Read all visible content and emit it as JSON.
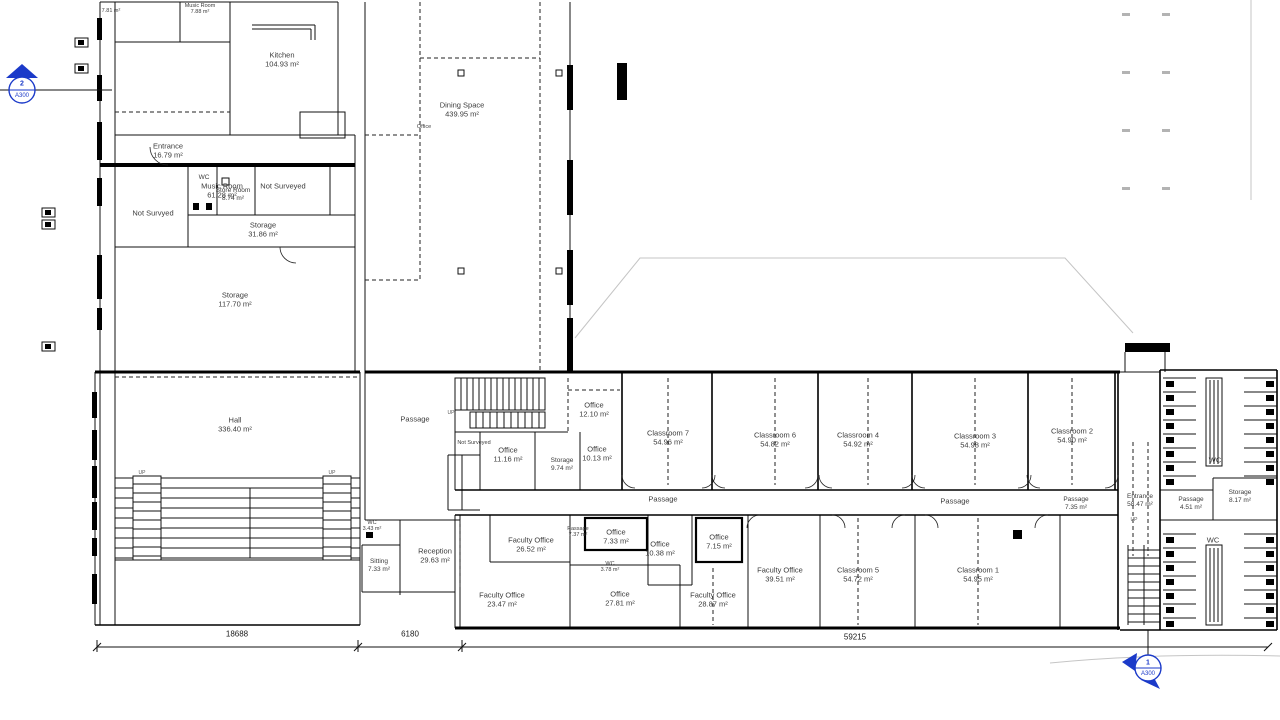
{
  "colors": {
    "wall": "#000000",
    "annotation_blue": "#1b3ac9",
    "site_gray": "#bdbdbd"
  },
  "up_label": "UP",
  "dimensions": {
    "d1": "18688",
    "d2": "6180",
    "d3": "59215"
  },
  "markers": {
    "left": {
      "number": "2",
      "sheet": "A300"
    },
    "bottom": {
      "number": "1",
      "sheet": "A300"
    }
  },
  "rooms": {
    "music_room_upper": {
      "name": "Music Room",
      "area": "7.88 m²"
    },
    "room_781": {
      "name": "",
      "area": "7.81 m²"
    },
    "music_room": {
      "name": "Music Room",
      "area": "61.28 m²"
    },
    "kitchen": {
      "name": "Kitchen",
      "area": "104.93 m²"
    },
    "dining_space": {
      "name": "Dining Space",
      "area": "439.95 m²"
    },
    "entrance_west": {
      "name": "Entrance",
      "area": "16.79 m²"
    },
    "wc_west": {
      "name": "WC",
      "area": ""
    },
    "store_room": {
      "name": "Store Room",
      "area": "8.74 m²"
    },
    "not_surveyed_east": {
      "name": "Not Surveyed",
      "area": ""
    },
    "not_survyed_west": {
      "name": "Not Survyed",
      "area": ""
    },
    "storage_small": {
      "name": "Storage",
      "area": "31.86 m²"
    },
    "storage_large": {
      "name": "Storage",
      "area": "117.70 m²"
    },
    "hall": {
      "name": "Hall",
      "area": "336.40 m²"
    },
    "passage_hall": {
      "name": "Passage",
      "area": ""
    },
    "office_top_small": {
      "name": "Office",
      "area": ""
    },
    "office_1210": {
      "name": "Office",
      "area": "12.10 m²"
    },
    "office_1116": {
      "name": "Office",
      "area": "11.16 m²"
    },
    "storage_974": {
      "name": "Storage",
      "area": "9.74 m²"
    },
    "office_1013": {
      "name": "Office",
      "area": "10.13 m²"
    },
    "not_surveyed_small": {
      "name": "Not Surveyed",
      "area": ""
    },
    "classroom_7": {
      "name": "Classroom 7",
      "area": "54.96 m²"
    },
    "classroom_6": {
      "name": "Classroom 6",
      "area": "54.82 m²"
    },
    "classroom_4": {
      "name": "Classroom 4",
      "area": "54.92 m²"
    },
    "classroom_3": {
      "name": "Classroom 3",
      "area": "54.98 m²"
    },
    "classroom_2": {
      "name": "Classroom 2",
      "area": "54.90 m²"
    },
    "passage_corridor_west": {
      "name": "Passage",
      "area": ""
    },
    "passage_corridor_east": {
      "name": "Passage",
      "area": ""
    },
    "passage_735": {
      "name": "Passage",
      "area": "7.35 m²"
    },
    "entrance_east": {
      "name": "Entrance",
      "area": "58.47 m²"
    },
    "passage_451": {
      "name": "Passage",
      "area": "4.51 m²"
    },
    "storage_817": {
      "name": "Storage",
      "area": "8.17 m²"
    },
    "wc_north": {
      "name": "WC",
      "area": ""
    },
    "wc_south": {
      "name": "WC",
      "area": ""
    },
    "sitting": {
      "name": "Sitting",
      "area": "7.33 m²"
    },
    "reception": {
      "name": "Reception",
      "area": "29.63 m²"
    },
    "faculty_2652": {
      "name": "Faculty Office",
      "area": "26.52 m²"
    },
    "faculty_2347": {
      "name": "Faculty Office",
      "area": "23.47 m²"
    },
    "office_733": {
      "name": "Office",
      "area": "7.33 m²"
    },
    "office_1038": {
      "name": "Office",
      "area": "10.38 m²"
    },
    "office_715": {
      "name": "Office",
      "area": "7.15 m²"
    },
    "office_2781": {
      "name": "Office",
      "area": "27.81 m²"
    },
    "faculty_2887": {
      "name": "Faculty Office",
      "area": "28.87 m²"
    },
    "faculty_3951": {
      "name": "Faculty Office",
      "area": "39.51 m²"
    },
    "classroom_5": {
      "name": "Classroom 5",
      "area": "54.72 m²"
    },
    "classroom_1": {
      "name": "Classroom 1",
      "area": "54.95 m²"
    },
    "wc_343": {
      "name": "WC",
      "area": "3.43 m²"
    },
    "passage_737": {
      "name": "Passage",
      "area": "7.37 m²"
    },
    "wc_378": {
      "name": "WC",
      "area": "3.78 m²"
    }
  }
}
